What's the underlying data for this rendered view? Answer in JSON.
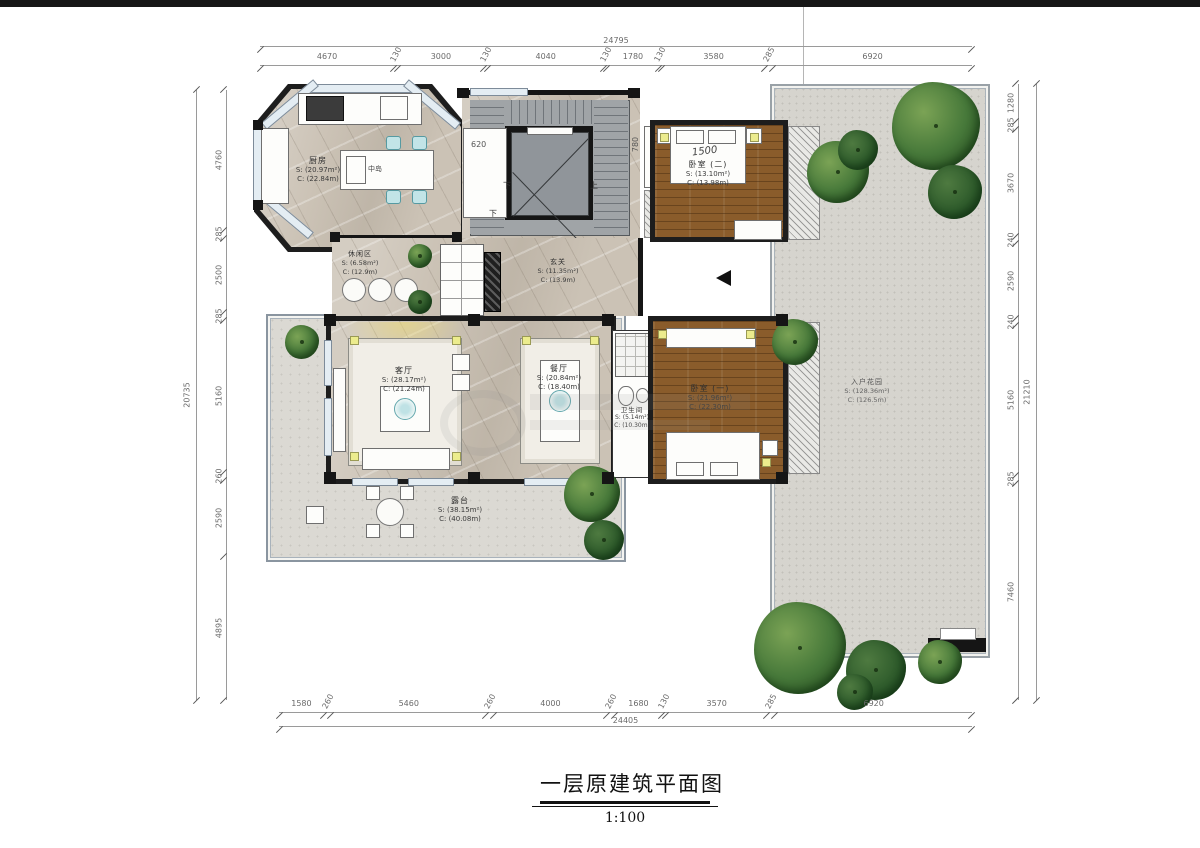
{
  "title": {
    "text": "一层原建筑平面图",
    "scale": "1:100"
  },
  "dims": {
    "top": {
      "total": "24795",
      "segments": [
        "4670",
        "130",
        "3000",
        "130",
        "4040",
        "130",
        "1780",
        "130",
        "3580",
        "285",
        "6920"
      ]
    },
    "bottom": {
      "total": "24405",
      "segments": [
        "1580",
        "260",
        "5460",
        "260",
        "4000",
        "260",
        "1680",
        "130",
        "3570",
        "285",
        "6920"
      ]
    },
    "left": {
      "total": "20735",
      "segments": [
        "4760",
        "285",
        "2500",
        "285",
        "5160",
        "260",
        "2590",
        "4895"
      ]
    },
    "right": {
      "total": "21210",
      "segments": [
        "1280",
        "285",
        "3670",
        "240",
        "2590",
        "240",
        "5160",
        "285",
        "7460"
      ]
    }
  },
  "rooms": {
    "kitchen": {
      "name": "厨房",
      "area": "S: (20.97m²)",
      "perimeter": "C: (22.84m)"
    },
    "island": {
      "name": "中岛"
    },
    "lounge": {
      "name": "休闲区",
      "area": "S: (6.58m²)",
      "perimeter": "C: (12.9m)"
    },
    "foyer": {
      "name": "玄关",
      "area": "S: (11.35m²)",
      "perimeter": "C: (13.9m)"
    },
    "living": {
      "name": "客厅",
      "area": "S: (28.17m²)",
      "perimeter": "C: (21.24m)"
    },
    "dining": {
      "name": "餐厅",
      "area": "S: (20.84m²)",
      "perimeter": "C: (18.40m)"
    },
    "bedroom2": {
      "name": "卧室 (二)",
      "area": "S: (13.10m²)",
      "perimeter": "C: (13.98m)"
    },
    "bedroom1": {
      "name": "卧室 (一)",
      "area": "S: (21.96m²)",
      "perimeter": "C: (22.30m)"
    },
    "bath": {
      "name": "卫生间",
      "area": "S: (5.14m²)",
      "perimeter": "C: (10.30m)"
    },
    "terrace": {
      "name": "露台",
      "area": "S: (38.15m²)",
      "perimeter": "C: (40.08m)"
    },
    "garden": {
      "name": "入户花园",
      "area": "S: (128.36m²)",
      "perimeter": "C: (126.5m)"
    }
  },
  "annotations": {
    "bed_width": "1500",
    "stair_up": "上",
    "stair_down": "下",
    "stair_down2": "下",
    "closet_dim": "620",
    "niche_dim": "780"
  },
  "colors": {
    "wall": "#1d1d1d",
    "floor_beige": "#cbc2b5",
    "wood": "#8a5c2b",
    "terrace": "#dbd9d3",
    "garden": "#d6d4ce",
    "stair_gray": "#a0a4a7",
    "window": "#e4edf3",
    "tree_green": "#47793a",
    "accent_teal": "#c2e4e7",
    "marker_yellow": "#ecec8d"
  }
}
